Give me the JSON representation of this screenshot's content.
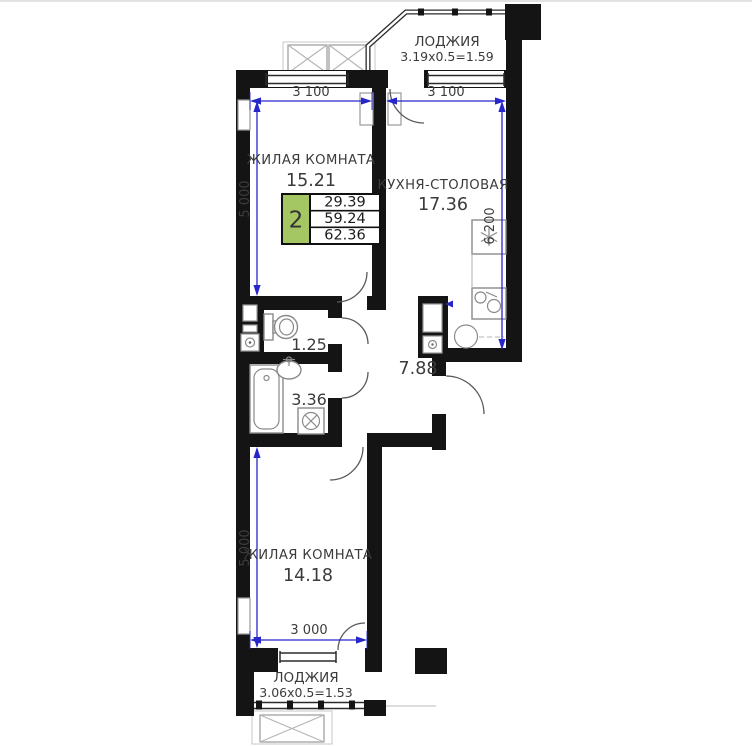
{
  "title": "2-room apartment floor plan",
  "rooms": {
    "living1": {
      "name": "ЖИЛАЯ КОМНАТА",
      "area": "15.21"
    },
    "kitchen": {
      "name": "КУХНЯ-СТОЛОВАЯ",
      "area": "17.36"
    },
    "wc": {
      "area": "1.25"
    },
    "bathroom": {
      "area": "3.36"
    },
    "hall": {
      "area": "7.88"
    },
    "living2": {
      "name": "ЖИЛАЯ КОМНАТА",
      "area": "14.18"
    },
    "loggia_top": {
      "name": "ЛОДЖИЯ",
      "size": "3.19х0.5=1.59"
    },
    "loggia_bottom": {
      "name": "ЛОДЖИЯ",
      "size": "3.06х0.5=1.53"
    }
  },
  "info_box": {
    "rooms_count": "2",
    "living_area": "29.39",
    "apartment_area": "59.24",
    "total_area": "62.36"
  },
  "dimensions": {
    "living1_width": "3 100",
    "kitchen_width": "3 100",
    "living1_depth": "5 000",
    "kitchen_depth": "6 200",
    "living2_depth": "5 000",
    "living2_width": "3 000"
  },
  "icons": {
    "fridge": "snowflake",
    "stove": "burner-circle",
    "kitchen_sink": "double-bowl",
    "toilet": "tank-and-bowl",
    "bathtub": "tub-outline",
    "bath_sink": "oval-with-tap",
    "washing_machine": "box-circle-cross",
    "ac_unit": "crossed-box",
    "utility_meter": "dial-box"
  },
  "colors": {
    "walls": "#141414",
    "dimension_lines": "#2626cb",
    "info_green": "#a5c763",
    "fixtures": "#8a8a8a",
    "text": "#3b3b3b"
  }
}
